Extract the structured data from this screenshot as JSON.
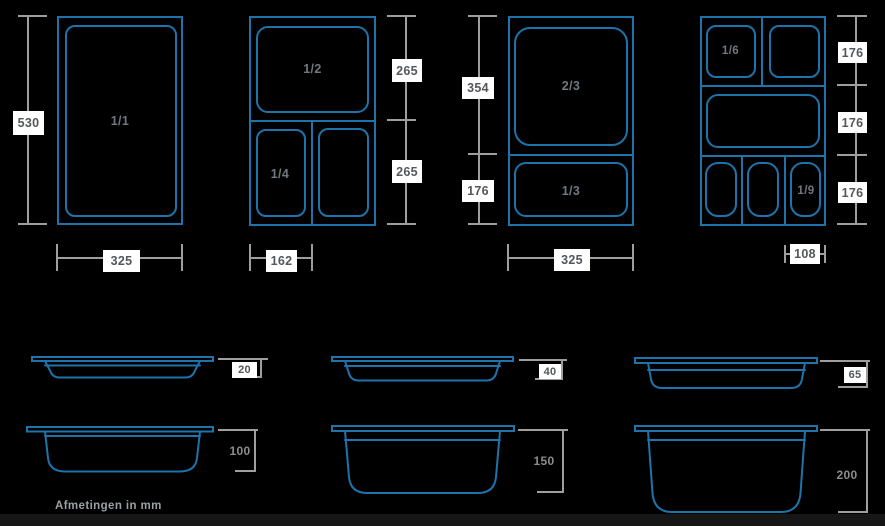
{
  "footnote": "Afmetingen in mm",
  "colors": {
    "background": "#000000",
    "pan_outline_blue": "#1d73aa",
    "dimension_gray": "#9e9e9e",
    "label_box_bg": "#ffffff",
    "label_text": "#54575b",
    "pan_label_text": "#70777e",
    "depth_label_gray": "#8c8c8c",
    "footnote_gray": "#9aa0a3",
    "bottom_bar": "#161616"
  },
  "top_views": {
    "full_pan": {
      "label": "1/1",
      "height_mm": "530",
      "width_mm": "325"
    },
    "half_quarter": {
      "half_label": "1/2",
      "quarter_label": "1/4",
      "half_height_mm": "265",
      "quarter_height_mm": "265",
      "quarter_width_mm": "162"
    },
    "two_thirds_third": {
      "two_thirds_label": "2/3",
      "third_label": "1/3",
      "two_thirds_height_mm": "354",
      "third_height_mm": "176",
      "width_mm": "325"
    },
    "sixth_ninth": {
      "sixth_label": "1/6",
      "ninth_label": "1/9",
      "row1_height_mm": "176",
      "row2_height_mm": "176",
      "row3_height_mm": "176",
      "ninth_width_mm": "108"
    }
  },
  "side_views": {
    "depths_mm": [
      "20",
      "40",
      "65",
      "100",
      "150",
      "200"
    ]
  }
}
